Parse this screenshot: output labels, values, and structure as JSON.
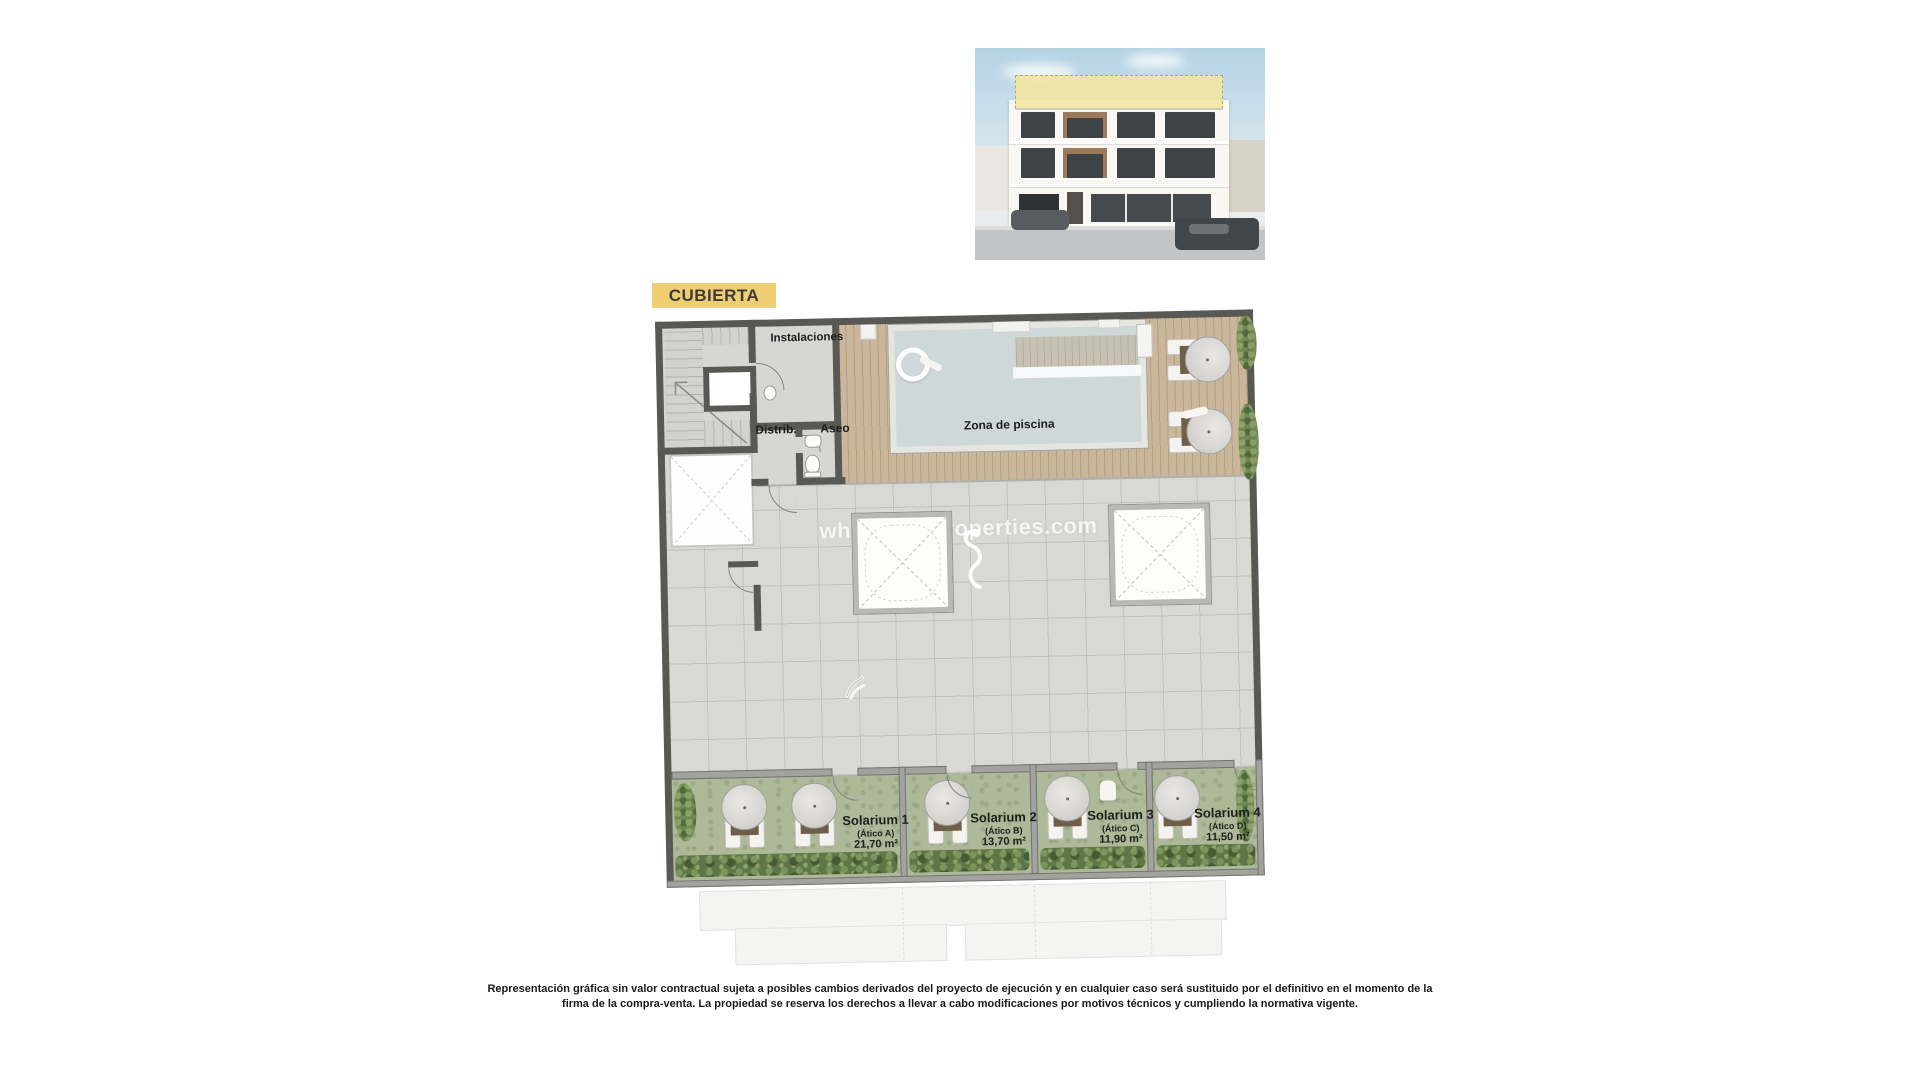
{
  "badge": {
    "label": "CUBIERTA"
  },
  "plan": {
    "rooms": {
      "instalaciones": "Instalaciones",
      "distrib": "Distrib.",
      "aseo": "Aseo",
      "pool_zone": "Zona de piscina"
    },
    "solariums": [
      {
        "name": "Solarium 1",
        "unit": "(Ático A)",
        "area": "21,70 m²"
      },
      {
        "name": "Solarium 2",
        "unit": "(Ático B)",
        "area": "13,70 m²"
      },
      {
        "name": "Solarium 3",
        "unit": "(Ático C)",
        "area": "11,90 m²"
      },
      {
        "name": "Solarium 4",
        "unit": "(Ático D)",
        "area": "11,50 m²"
      }
    ],
    "watermark": "whitesandproperties.com"
  },
  "footer": {
    "line1": "Representación gráfica sin valor contractual sujeta a posibles cambios derivados del proyecto de ejecución y en cualquier caso será sustituido por el definitivo en el momento de la",
    "line2": "firma de la compra-venta. La propiedad se reserva los derechos a llevar a cabo modificaciones por motivos técnicos y cumpliendo la normativa vigente."
  },
  "colors": {
    "badge_yellow": "#efce72",
    "wall_dark": "#585854",
    "deck_wood": "#cab69b",
    "pool_water": "#ced8d9",
    "terrace_gray": "#d8d8d5",
    "solarium_grass": "#adb998",
    "roof_highlight": "#f3e59c"
  }
}
